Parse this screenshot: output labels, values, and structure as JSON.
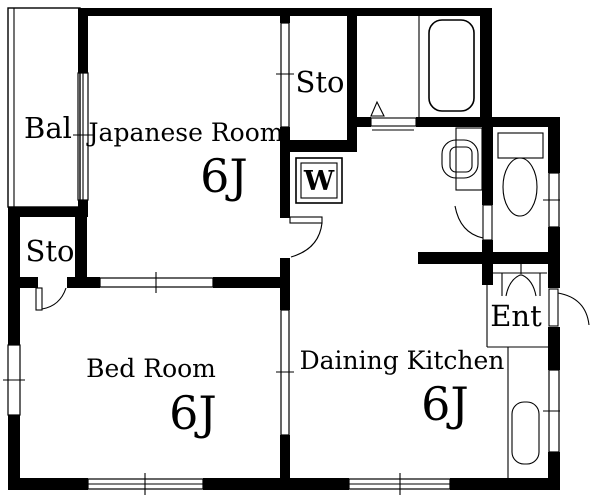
{
  "floorplan": {
    "background": "#ffffff",
    "line_color": "#000000",
    "rooms": {
      "japanese_room": {
        "name": "Japanese Room",
        "size": "6J"
      },
      "bed_room": {
        "name": "Bed Room",
        "size": "6J"
      },
      "dining_kitchen": {
        "name": "Daining Kitchen",
        "size": "6J"
      },
      "balcony": {
        "name": "Bal"
      },
      "storage_top": {
        "name": "Sto"
      },
      "storage_left": {
        "name": "Sto"
      },
      "entrance": {
        "name": "Ent"
      },
      "washing_machine": {
        "label": "W"
      }
    }
  }
}
